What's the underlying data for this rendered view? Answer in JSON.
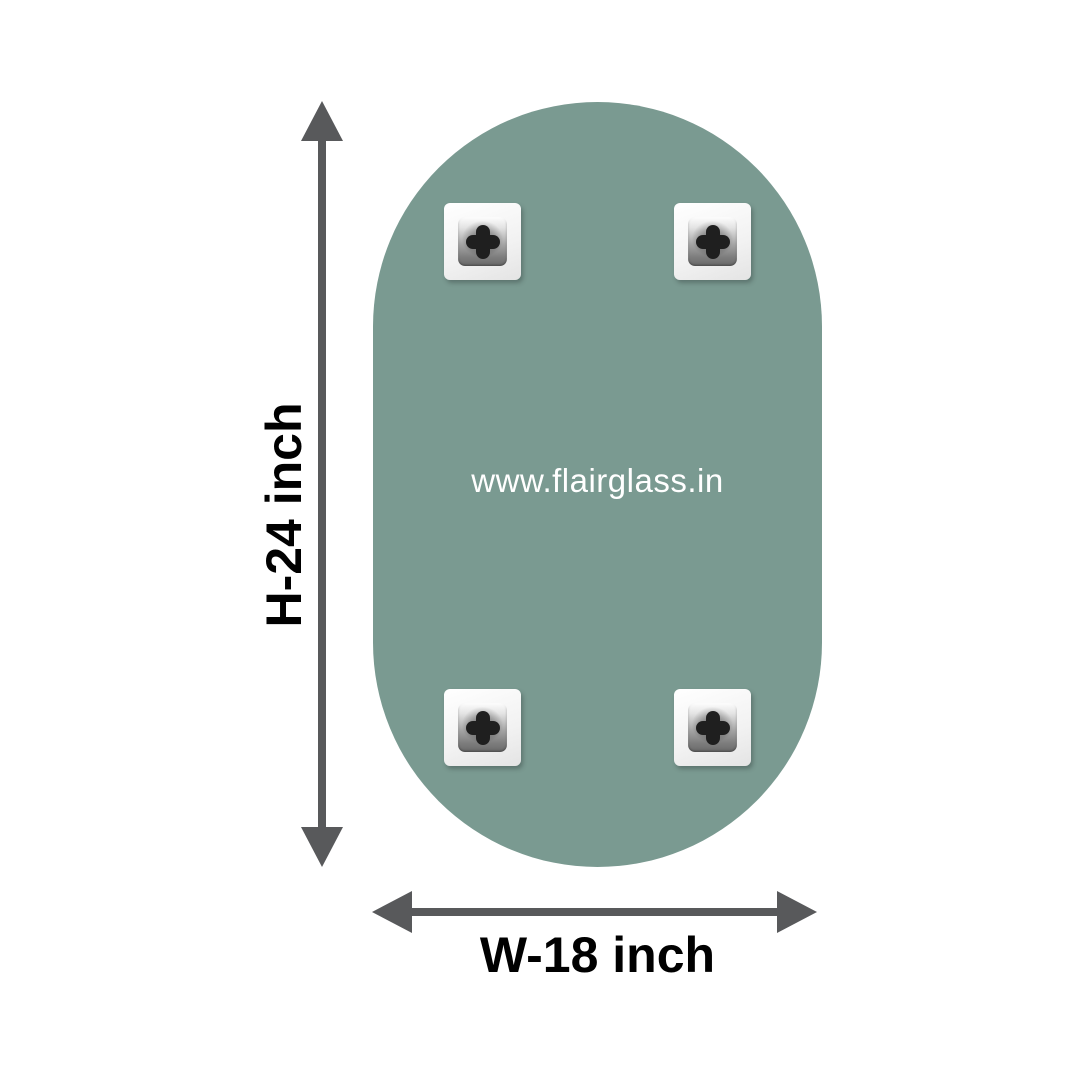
{
  "diagram": {
    "watermark": "www.flairglass.in",
    "height_label": "H-24 inch",
    "width_label": "W-18 inch",
    "clip_count": 4,
    "icons": {
      "screw": "screw-cross-icon",
      "height_arrow": "double-arrow-vertical-icon",
      "width_arrow": "double-arrow-horizontal-icon"
    },
    "colors": {
      "glass_green": "#7a9a91",
      "arrow_gray": "#58595b",
      "dimension_text": "#000000",
      "watermark_text": "#ffffff",
      "clip_white": "#f5f5f5",
      "background": "#ffffff"
    }
  }
}
